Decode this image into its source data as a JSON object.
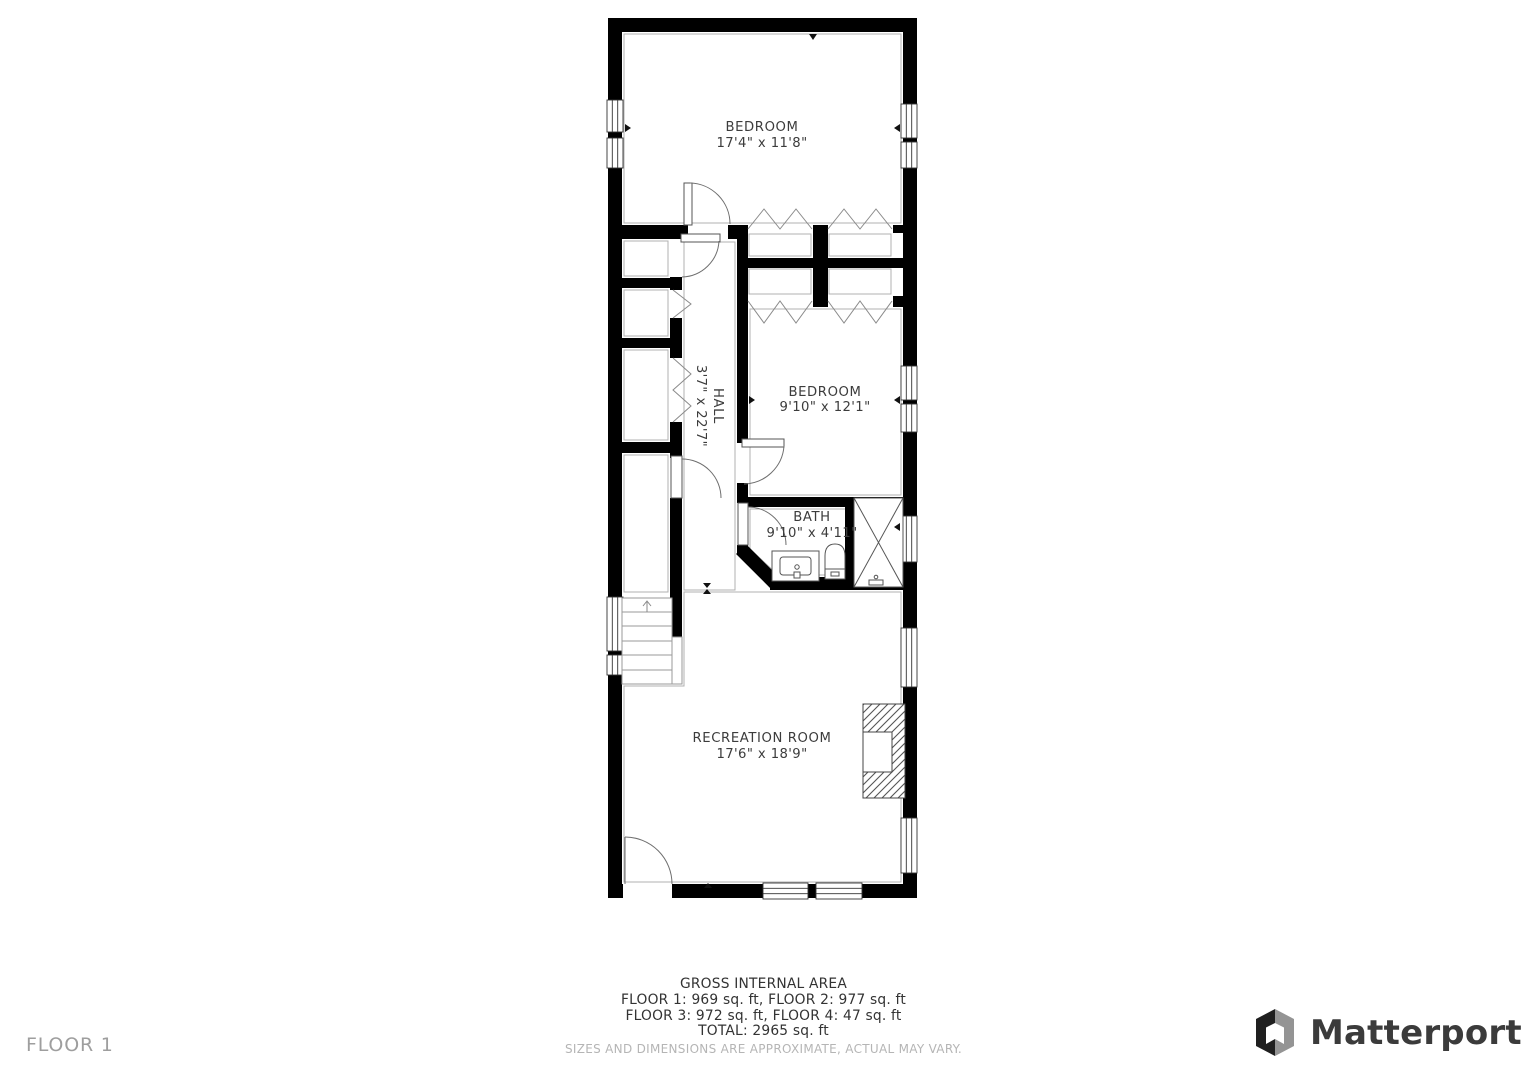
{
  "floor_plan": {
    "rooms": [
      {
        "name": "BEDROOM",
        "dims": "17'4\" x 11'8\""
      },
      {
        "name": "BEDROOM",
        "dims": "9'10\" x 12'1\""
      },
      {
        "name": "HALL",
        "dims": "3'7\" x 22'7\""
      },
      {
        "name": "BATH",
        "dims": "9'10\" x 4'11\""
      },
      {
        "name": "RECREATION ROOM",
        "dims": "17'6\" x 18'9\""
      }
    ]
  },
  "footer": {
    "title": "GROSS INTERNAL AREA",
    "line1": "FLOOR 1: 969 sq. ft, FLOOR 2: 977 sq. ft",
    "line2": "FLOOR 3: 972 sq. ft, FLOOR 4: 47 sq. ft",
    "total": "TOTAL: 2965 sq. ft",
    "disclaimer": "SIZES AND DIMENSIONS ARE APPROXIMATE, ACTUAL MAY VARY."
  },
  "floor_label": "FLOOR 1",
  "branding": {
    "wordmark": "Matterport"
  },
  "colors": {
    "wall": "#000000",
    "room_outline": "#b0b0b0",
    "label_text": "#3c3c3c",
    "footer_text": "#333333",
    "footer_muted": "#b5b5b5",
    "floor_label_text": "#9e9e9e",
    "logo_dark": "#1f1f1f",
    "logo_gray": "#949494"
  }
}
